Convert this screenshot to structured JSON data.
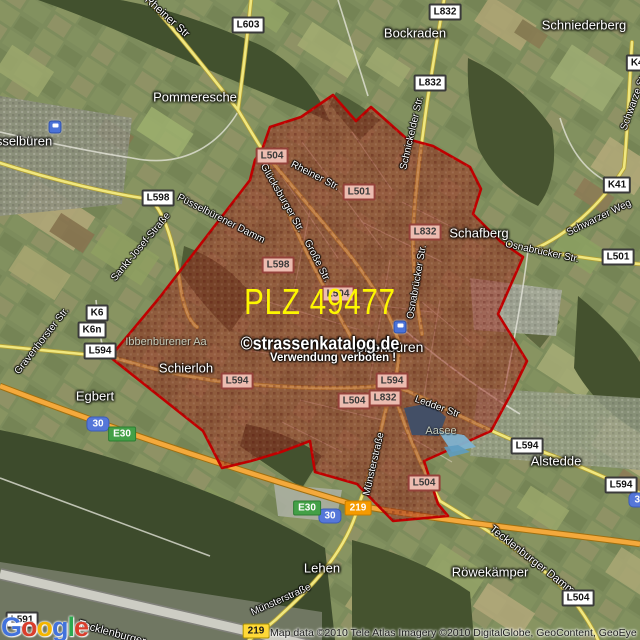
{
  "overlay": {
    "plz_label": "PLZ 49477",
    "watermark_line1": "©strassenkatalog.de",
    "watermark_line2": "Verwendung verboten !"
  },
  "attribution": {
    "text": "Map data ©2010 Tele Atlas Imagery ©2010 DigitalGlobe, GeoContent, GeoEye"
  },
  "logo": {
    "name": "Google",
    "letters": [
      {
        "ch": "G",
        "color": "#4272db"
      },
      {
        "ch": "o",
        "color": "#d93e2c"
      },
      {
        "ch": "o",
        "color": "#f3b500"
      },
      {
        "ch": "g",
        "color": "#4272db"
      },
      {
        "ch": "l",
        "color": "#2ca94f"
      },
      {
        "ch": "e",
        "color": "#d93e2c"
      }
    ]
  },
  "colors": {
    "zone_fill": "#9c2c1e",
    "zone_border": "#c00000",
    "plz_text": "#fdf700",
    "highway": "#f4a93c",
    "road": "#f0e77e"
  },
  "places": [
    {
      "name": "Pommeresche",
      "x": 195,
      "y": 97
    },
    {
      "name": "Bockraden",
      "x": 415,
      "y": 33
    },
    {
      "name": "Schniederberg",
      "x": 584,
      "y": 25
    },
    {
      "name": "sselbüren",
      "x": 24,
      "y": 141
    },
    {
      "name": "Schafberg",
      "x": 479,
      "y": 233
    },
    {
      "name": "Ibbenbüren",
      "x": 388,
      "y": 347,
      "size": 14
    },
    {
      "name": "Schierloh",
      "x": 186,
      "y": 368
    },
    {
      "name": "Egbert",
      "x": 95,
      "y": 396
    },
    {
      "name": "Alstedde",
      "x": 556,
      "y": 461
    },
    {
      "name": "Lehen",
      "x": 322,
      "y": 568
    },
    {
      "name": "Röwekämper",
      "x": 490,
      "y": 572
    },
    {
      "name": "Ibbenbürener Aa",
      "x": 166,
      "y": 342,
      "style": "water"
    },
    {
      "name": "Aasee",
      "x": 441,
      "y": 431,
      "style": "water"
    }
  ],
  "streets": [
    {
      "name": "Rheiner Str",
      "x": 167,
      "y": 17,
      "rot": 42,
      "size": 11
    },
    {
      "name": "Rheiner Str.",
      "x": 315,
      "y": 176,
      "rot": 27
    },
    {
      "name": "Glücksburger Str.",
      "x": 282,
      "y": 198,
      "rot": 60
    },
    {
      "name": "Püsselbürener Damm",
      "x": 221,
      "y": 219,
      "rot": 27
    },
    {
      "name": "Sankt-Josef-Straße",
      "x": 141,
      "y": 247,
      "rot": -50
    },
    {
      "name": "Schnickelder Str.",
      "x": 412,
      "y": 133,
      "rot": -77
    },
    {
      "name": "Schwarze Str",
      "x": 634,
      "y": 102,
      "rot": -70
    },
    {
      "name": "Schwarzer Weg",
      "x": 599,
      "y": 218,
      "rot": -26
    },
    {
      "name": "Osnabrücker Str.",
      "x": 542,
      "y": 252,
      "rot": 12
    },
    {
      "name": "Osnabrücker Str.",
      "x": 417,
      "y": 282,
      "rot": -80
    },
    {
      "name": "Große Str.",
      "x": 317,
      "y": 261,
      "rot": 63
    },
    {
      "name": "Ledder Str",
      "x": 437,
      "y": 407,
      "rot": 20
    },
    {
      "name": "Münsterstraße",
      "x": 374,
      "y": 464,
      "rot": -77
    },
    {
      "name": "Münsterstraße",
      "x": 281,
      "y": 600,
      "rot": -24
    },
    {
      "name": "Tecklenburger Damm",
      "x": 532,
      "y": 560,
      "rot": 38,
      "size": 11
    },
    {
      "name": "Tecklenburger",
      "x": 112,
      "y": 633,
      "rot": 15,
      "size": 11
    },
    {
      "name": "Gravenhorster Str.",
      "x": 42,
      "y": 341,
      "rot": -52
    }
  ],
  "shields": [
    {
      "label": "L603",
      "x": 248,
      "y": 25,
      "style": "white"
    },
    {
      "label": "L832",
      "x": 445,
      "y": 12,
      "style": "white"
    },
    {
      "label": "L832",
      "x": 430,
      "y": 83,
      "style": "white"
    },
    {
      "label": "K41",
      "x": 640,
      "y": 63,
      "style": "white"
    },
    {
      "label": "L598",
      "x": 158,
      "y": 198,
      "style": "white"
    },
    {
      "label": "K6",
      "x": 97,
      "y": 313,
      "style": "white"
    },
    {
      "label": "K6n",
      "x": 92,
      "y": 330,
      "style": "white"
    },
    {
      "label": "L594",
      "x": 100,
      "y": 351,
      "style": "white"
    },
    {
      "label": "K41",
      "x": 617,
      "y": 185,
      "style": "white"
    },
    {
      "label": "L501",
      "x": 618,
      "y": 257,
      "style": "white"
    },
    {
      "label": "L594",
      "x": 527,
      "y": 446,
      "style": "white"
    },
    {
      "label": "L594",
      "x": 621,
      "y": 485,
      "style": "white"
    },
    {
      "label": "L504",
      "x": 578,
      "y": 598,
      "style": "white"
    },
    {
      "label": "L591",
      "x": 22,
      "y": 620,
      "style": "white"
    },
    {
      "label": "L504",
      "x": 272,
      "y": 156,
      "style": "pink"
    },
    {
      "label": "L501",
      "x": 359,
      "y": 192,
      "style": "pink"
    },
    {
      "label": "L832",
      "x": 425,
      "y": 232,
      "style": "pink"
    },
    {
      "label": "L598",
      "x": 278,
      "y": 265,
      "style": "pink"
    },
    {
      "label": "L504",
      "x": 338,
      "y": 294,
      "style": "pink"
    },
    {
      "label": "L594",
      "x": 392,
      "y": 381,
      "style": "pink"
    },
    {
      "label": "L832",
      "x": 385,
      "y": 398,
      "style": "pink"
    },
    {
      "label": "L504",
      "x": 354,
      "y": 401,
      "style": "pink"
    },
    {
      "label": "L594",
      "x": 237,
      "y": 381,
      "style": "pink"
    },
    {
      "label": "L504",
      "x": 424,
      "y": 483,
      "style": "pink"
    },
    {
      "label": "30",
      "x": 98,
      "y": 424,
      "style": "blue"
    },
    {
      "label": "30",
      "x": 330,
      "y": 516,
      "style": "blue"
    },
    {
      "label": "30",
      "x": 640,
      "y": 500,
      "style": "blue"
    },
    {
      "label": "E30",
      "x": 122,
      "y": 434,
      "style": "green"
    },
    {
      "label": "E30",
      "x": 307,
      "y": 508,
      "style": "green"
    },
    {
      "label": "219",
      "x": 358,
      "y": 508,
      "style": "orange"
    },
    {
      "label": "219",
      "x": 256,
      "y": 631,
      "style": "yellow"
    }
  ],
  "icons": [
    {
      "name": "station-icon",
      "x": 55,
      "y": 127
    },
    {
      "name": "station-icon",
      "x": 400,
      "y": 327
    }
  ]
}
